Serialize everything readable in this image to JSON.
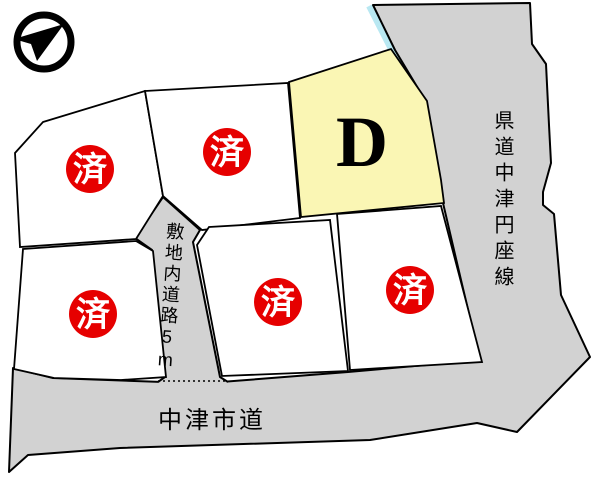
{
  "labels": {
    "prefectural_road": "県道中津円座線",
    "city_road": "中津市道",
    "internal_road": "敷地内道路5m"
  },
  "lots": [
    {
      "id": "top-left",
      "status": "済"
    },
    {
      "id": "top-center",
      "status": "済"
    },
    {
      "id": "lot-d",
      "status": "D"
    },
    {
      "id": "bottom-left",
      "status": "済"
    },
    {
      "id": "bottom-center",
      "status": "済"
    },
    {
      "id": "bottom-right",
      "status": "済"
    }
  ],
  "colors": {
    "road_fill": "#d2d2d2",
    "lot_fill": "#ffffff",
    "highlight_fill": "#faf6b4",
    "sold_badge": "#e60000",
    "badge_text": "#ffffff",
    "water_strip": "#b9e8f2",
    "outline": "#000000"
  }
}
